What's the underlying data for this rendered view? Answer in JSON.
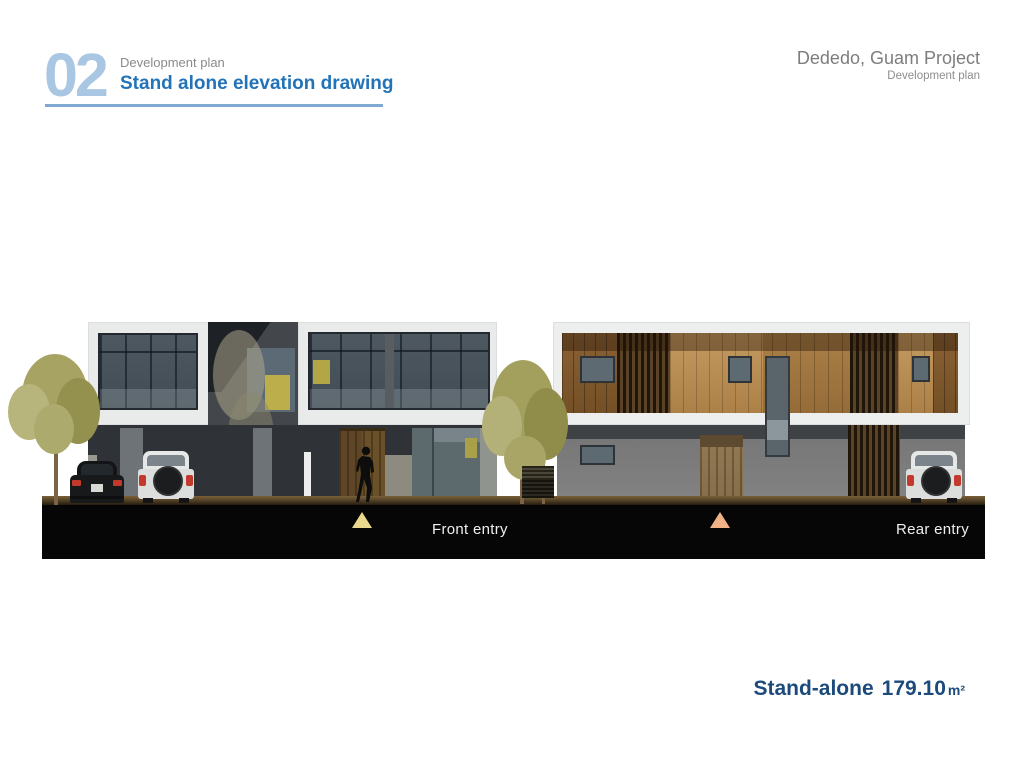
{
  "header": {
    "section_number": "02",
    "section_subtitle": "Development plan",
    "section_title": "Stand alone elevation drawing"
  },
  "project": {
    "title": "Dededo, Guam Project",
    "subtitle": "Development plan"
  },
  "captions": {
    "front_entry": "Front entry",
    "rear_entry": "Rear entry"
  },
  "footer": {
    "area_name": "Stand-alone",
    "area_value": "179.10",
    "area_unit": "m²"
  },
  "colors": {
    "section_number_blue": "#a9c6e3",
    "title_blue": "#2273b8",
    "underline_blue": "#7fa8d2",
    "heading_gray": "#8a8a8a",
    "project_gray": "#7d7d7d",
    "footer_navy": "#1b4a7b",
    "caption_band_black": "#060606",
    "front_marker_yellow": "#ead88e",
    "rear_marker_orange": "#f2b288"
  }
}
